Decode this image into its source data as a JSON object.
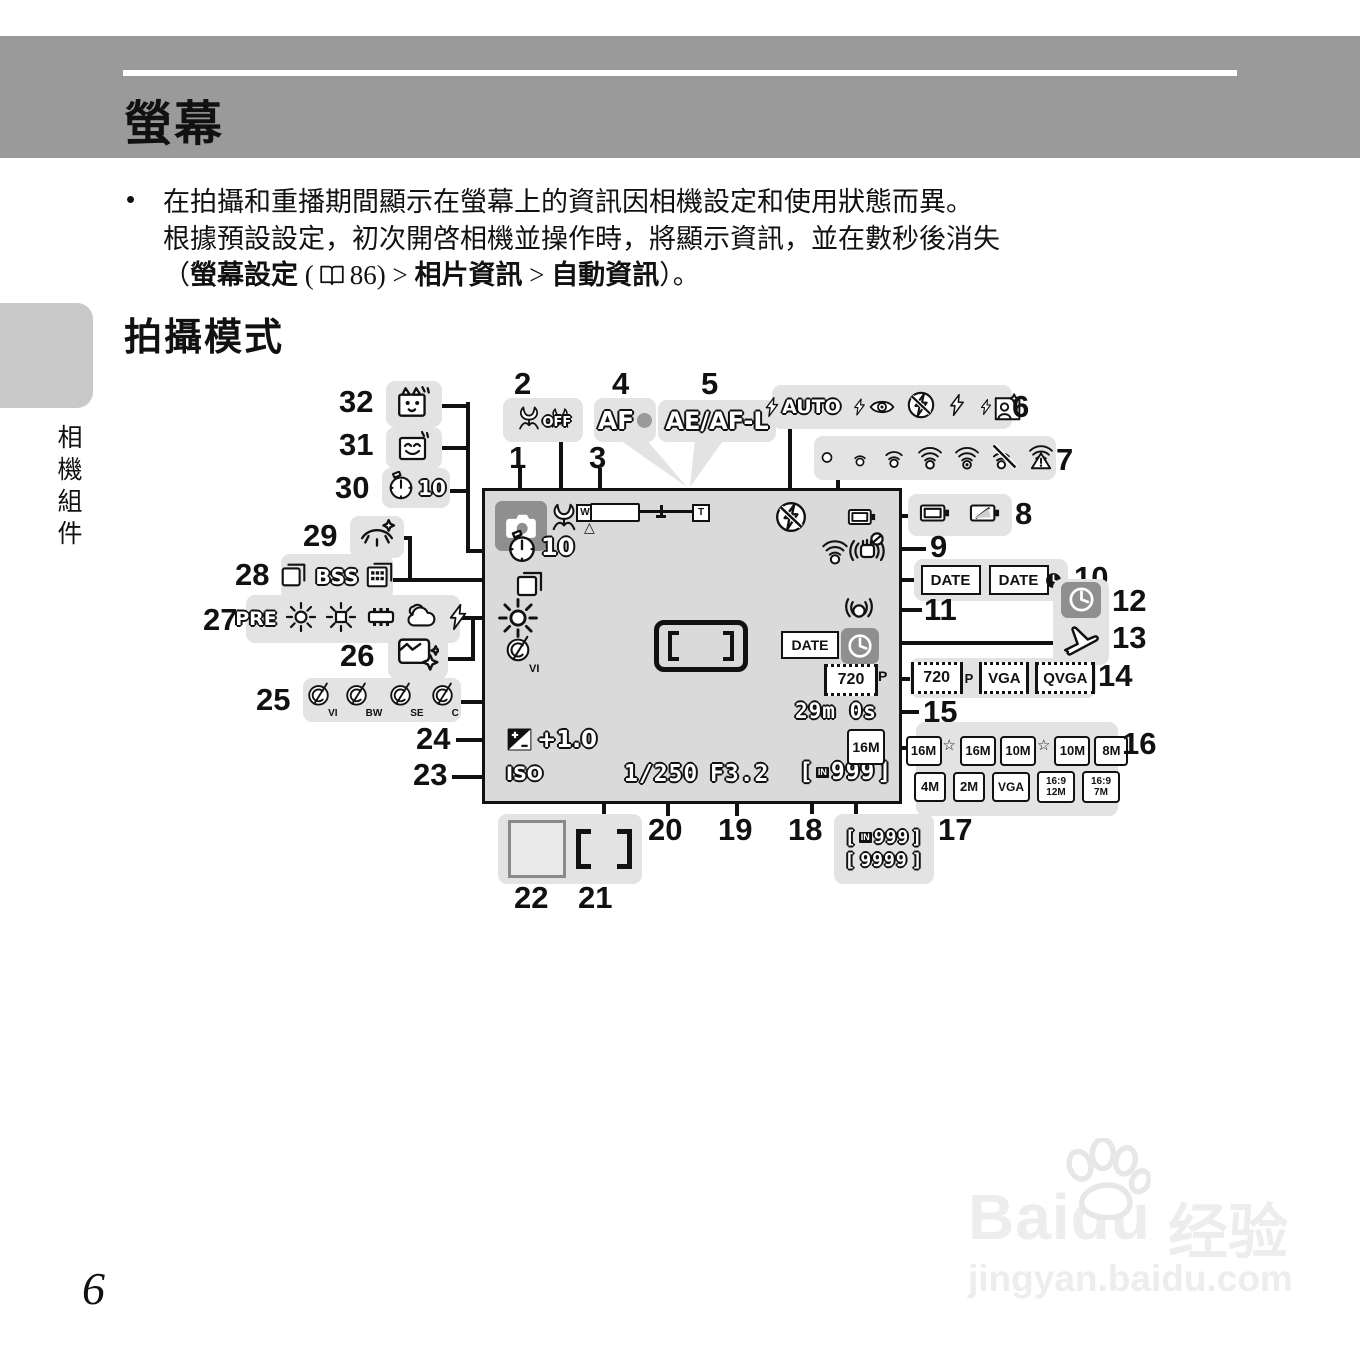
{
  "header": {
    "title": "螢幕"
  },
  "intro": {
    "bullet": "•",
    "line1": "在拍攝和重播期間顯示在螢幕上的資訊因相機設定和使用狀態而異。",
    "line2": "根據預設設定，初次開啓相機並操作時，將顯示資訊，並在數秒後消失",
    "l3_open": "（",
    "l3_bold1": "螢幕設定",
    "l3_paren": "(",
    "l3_ref": "86) >",
    "l3_bold2": "相片資訊",
    "l3_gt": ">",
    "l3_bold3": "自動資訊",
    "l3_close": "）。"
  },
  "section": {
    "title": "拍攝模式"
  },
  "sidebar": {
    "label": "相機組件"
  },
  "page": {
    "number": "6"
  },
  "watermark": {
    "brand": "Baidu",
    "brand_cn": "经验",
    "domain": "jingyan.baidu.com"
  },
  "nums": {
    "1": "1",
    "2": "2",
    "3": "3",
    "4": "4",
    "5": "5",
    "6": "6",
    "7": "7",
    "8": "8",
    "9": "9",
    "10": "10",
    "11": "11",
    "12": "12",
    "13": "13",
    "14": "14",
    "15": "15",
    "16": "16",
    "17": "17",
    "18": "18",
    "19": "19",
    "20": "20",
    "21": "21",
    "22": "22",
    "23": "23",
    "24": "24",
    "25": "25",
    "26": "26",
    "27": "27",
    "28": "28",
    "29": "29",
    "30": "30",
    "31": "31",
    "32": "32"
  },
  "labels": {
    "macro_off": "OFF",
    "af": "AF",
    "ae_af_l": "AE/AF-L",
    "flash_auto": "AUTO",
    "bss": "BSS",
    "wb_pre": "PRE",
    "date": "DATE",
    "iso": "ISO",
    "timer10": "10",
    "exp": "+1.0",
    "shutter": "1/250",
    "aperture": "F3.2",
    "remaining": "29m 0s",
    "in_badge": "IN",
    "count999": "999",
    "count9999": "9999",
    "bracket_open": "[",
    "bracket_close": "]",
    "m720": "720",
    "p": "P",
    "vga": "VGA",
    "qvga": "QVGA",
    "s16": "16M",
    "s10": "10M",
    "s8": "8M",
    "s4": "4M",
    "s2": "2M",
    "r12": "16:9\n12M",
    "r7": "16:9\n7M",
    "star": "☆",
    "w": "W",
    "t": "T",
    "tri": "△",
    "style_vi": "VI",
    "style_bw": "BW",
    "style_se": "SE",
    "style_c": "C"
  }
}
